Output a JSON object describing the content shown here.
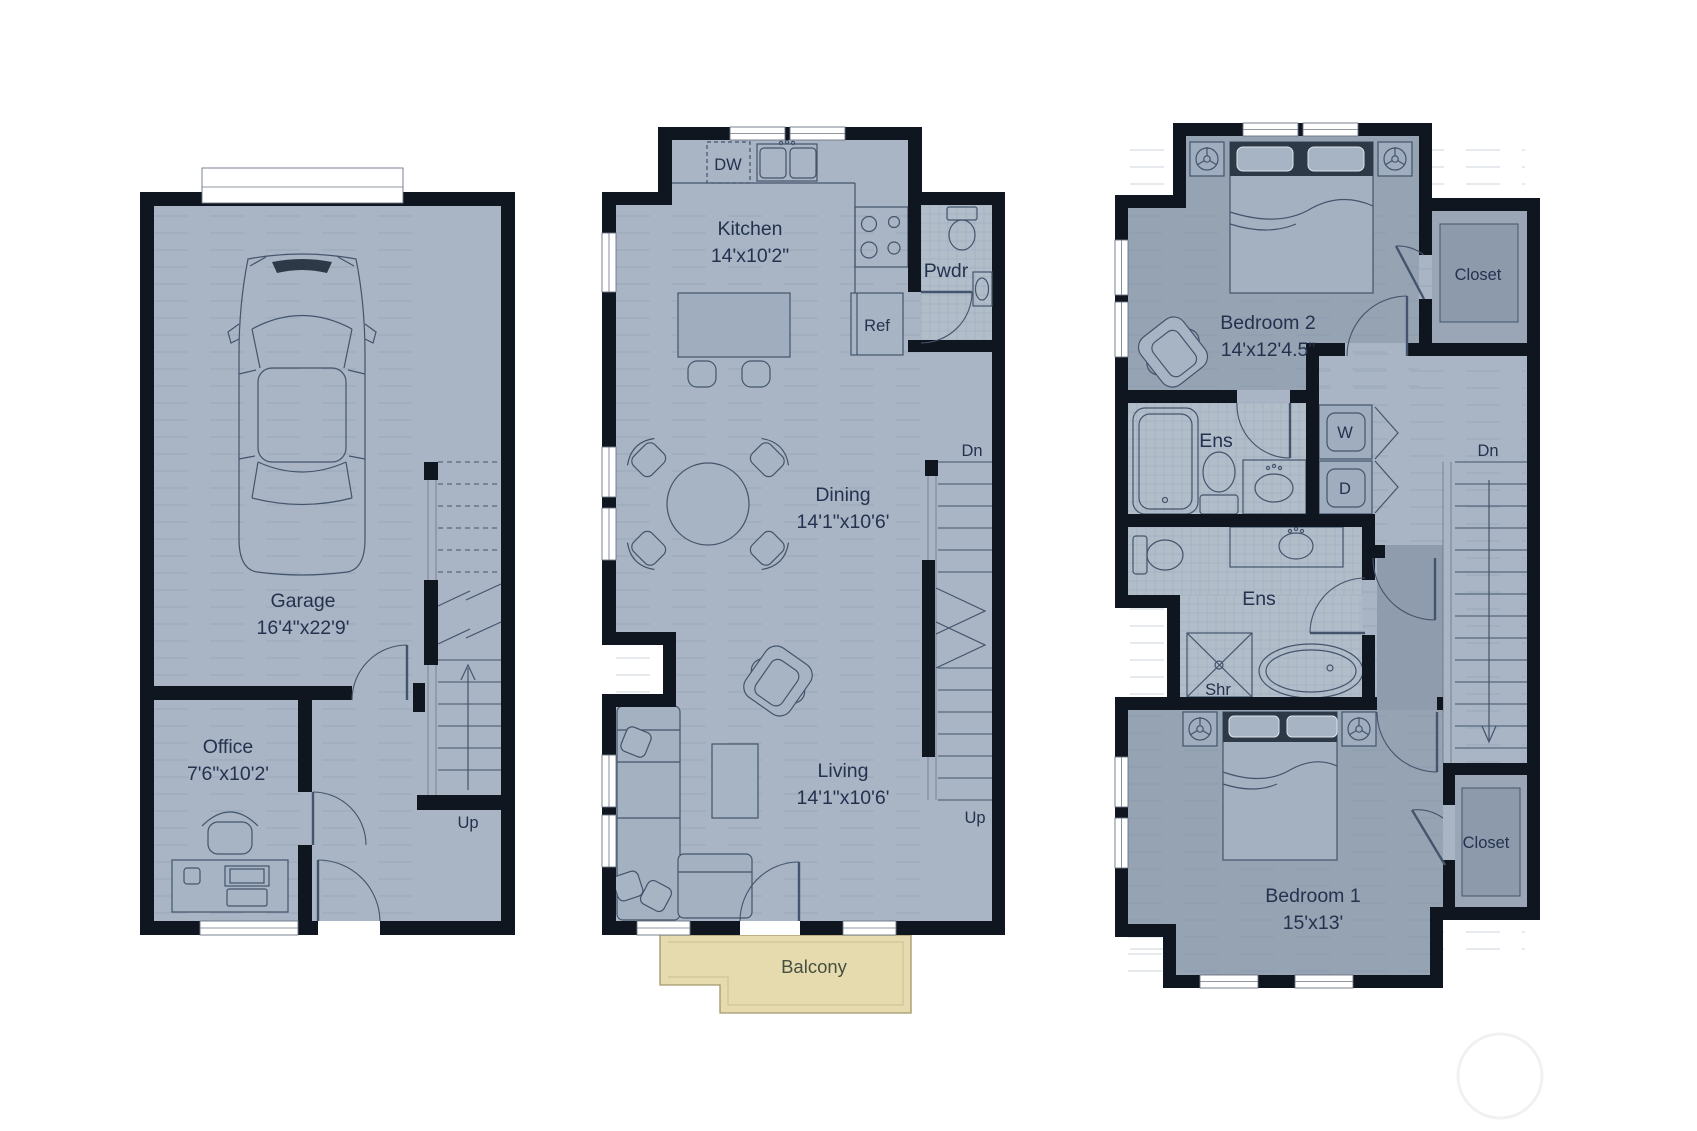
{
  "title": "Three-level townhouse floor plan",
  "colors": {
    "wall": "#10161f",
    "floor": "#a9b5c4",
    "bedroom_floor": "#96a3b3",
    "tile": "#b2bdca",
    "balcony": "#e6dbae",
    "line": "#44546c",
    "text": "#24324f"
  },
  "floors": {
    "garage": {
      "garage_label": "Garage",
      "garage_dims": "16'4\"x22'9'",
      "office_label": "Office",
      "office_dims": "7'6\"x10'2'",
      "stairs_up": "Up"
    },
    "main": {
      "kitchen_label": "Kitchen",
      "kitchen_dims": "14'x10'2\"",
      "dishwasher": "DW",
      "refrigerator": "Ref",
      "powder": "Pwdr",
      "dining_label": "Dining",
      "dining_dims": "14'1\"x10'6'",
      "living_label": "Living",
      "living_dims": "14'1\"x10'6'",
      "stairs_down": "Dn",
      "stairs_up": "Up",
      "balcony": "Balcony"
    },
    "upper": {
      "bedroom2_label": "Bedroom 2",
      "bedroom2_dims": "14'x12'4.5\"",
      "closet_top": "Closet",
      "ens_top": "Ens",
      "washer": "W",
      "dryer": "D",
      "stairs_down": "Dn",
      "ens_bottom": "Ens",
      "shower": "Shr",
      "bedroom1_label": "Bedroom 1",
      "bedroom1_dims": "15'x13'",
      "closet_bottom": "Closet"
    }
  }
}
